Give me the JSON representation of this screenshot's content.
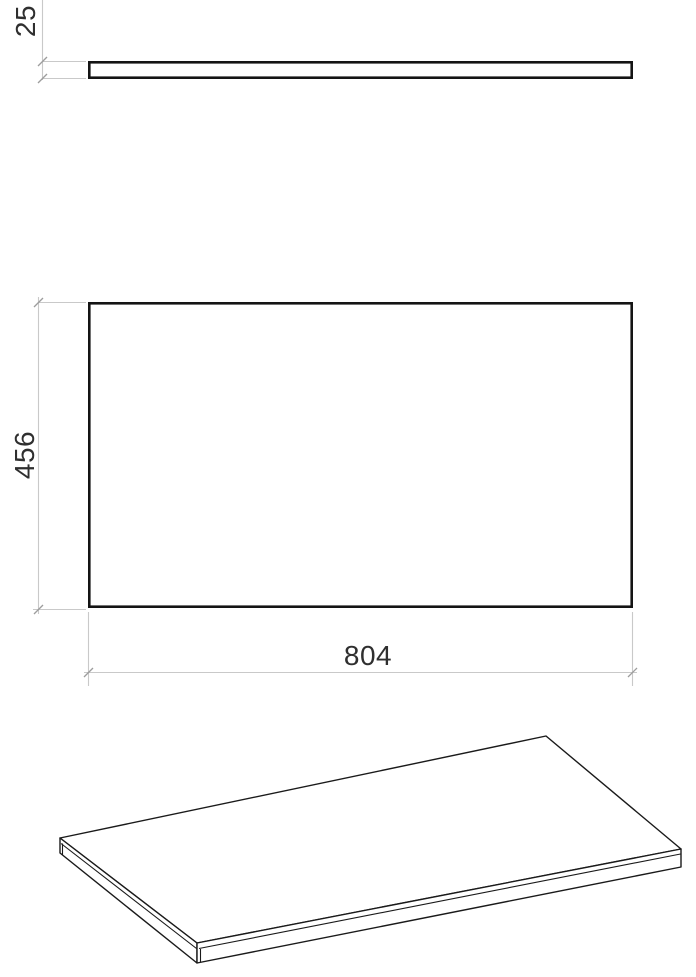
{
  "drawing": {
    "kind": "panel dimension drawing",
    "dimensions": {
      "thickness": "25",
      "depth": "456",
      "width": "804"
    },
    "colors": {
      "object_line": "#141414",
      "dimension_line": "#c9c9c9",
      "tick_mark": "#9d9d9d",
      "label_text": "#2f2f2f",
      "background": "#ffffff"
    }
  }
}
